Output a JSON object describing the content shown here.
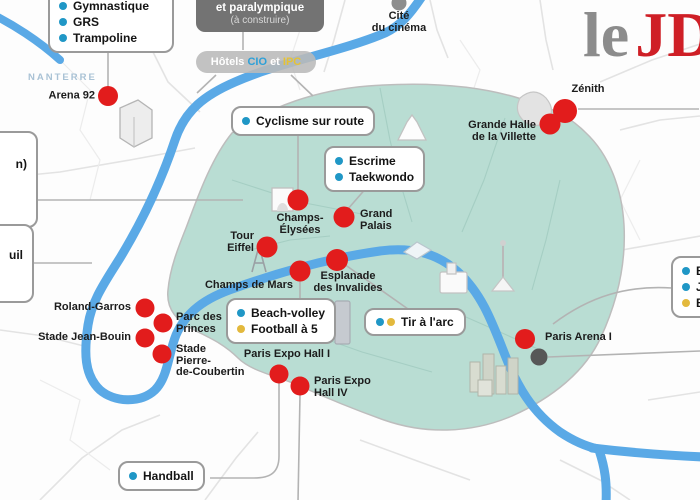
{
  "colors": {
    "red": "#e21c1c",
    "grayDot": "#575757",
    "blue": "#2097c6",
    "yellow": "#e3b93d",
    "teal": "#b9ddd3",
    "river": "#5aa9e6",
    "logoRed": "#cf1f26",
    "logoGray": "#8c8c8c",
    "regionBlue": "#a9c2d5"
  },
  "logo": {
    "le": "le",
    "jdd": "JD"
  },
  "regions": {
    "nanterre": "NANTERRE"
  },
  "legend_boxes": {
    "gymnastique": {
      "items": [
        "Gymnastique",
        "GRS",
        "Trampoline"
      ]
    },
    "paralympique": {
      "line1": "et paralympique",
      "line2": "(à construire)"
    },
    "hotels": {
      "hotels": "Hôtels",
      "cio": "CIO",
      "et": "et",
      "ipc": "IPC"
    },
    "cyclisme": {
      "label": "Cyclisme sur route"
    },
    "escrime": {
      "items": [
        "Escrime",
        "Taekwondo"
      ]
    },
    "beach": {
      "items": [
        "Beach-volley",
        "Football à 5"
      ]
    },
    "tir": {
      "label": "Tir à l'arc"
    },
    "handball": {
      "label": "Handball"
    },
    "right_partial": {
      "items": [
        "B",
        "J",
        "B"
      ]
    },
    "left_partial_top": {
      "label": "n)"
    },
    "left_partial_bottom": {
      "label": "uil"
    }
  },
  "venues": {
    "arena92": {
      "l1": "Arena 92"
    },
    "cite_cinema": {
      "l1": "Cité",
      "l2": "du cinéma"
    },
    "zenith": {
      "l1": "Zénith"
    },
    "grande_halle": {
      "l1": "Grande Halle",
      "l2": "de la Villette"
    },
    "champs_elysees": {
      "l1": "Champs-",
      "l2": "Élysées"
    },
    "grand_palais": {
      "l1": "Grand",
      "l2": "Palais"
    },
    "tour_eiffel": {
      "l1": "Tour",
      "l2": "Eiffel"
    },
    "champs_de_mars": {
      "l1": "Champs de Mars"
    },
    "esplanade": {
      "l1": "Esplanade",
      "l2": "des Invalides"
    },
    "roland_garros": {
      "l1": "Roland-Garros"
    },
    "parc_princes": {
      "l1": "Parc des",
      "l2": "Princes"
    },
    "stade_jean_bouin": {
      "l1": "Stade Jean-Bouin"
    },
    "stade_coubertin": {
      "l1": "Stade",
      "l2": "Pierre-",
      "l3": "de-Coubertin"
    },
    "paris_expo_1": {
      "l1": "Paris Expo Hall I"
    },
    "paris_expo_4": {
      "l1": "Paris Expo",
      "l2": "Hall IV"
    },
    "paris_arena": {
      "l1": "Paris Arena I"
    }
  }
}
